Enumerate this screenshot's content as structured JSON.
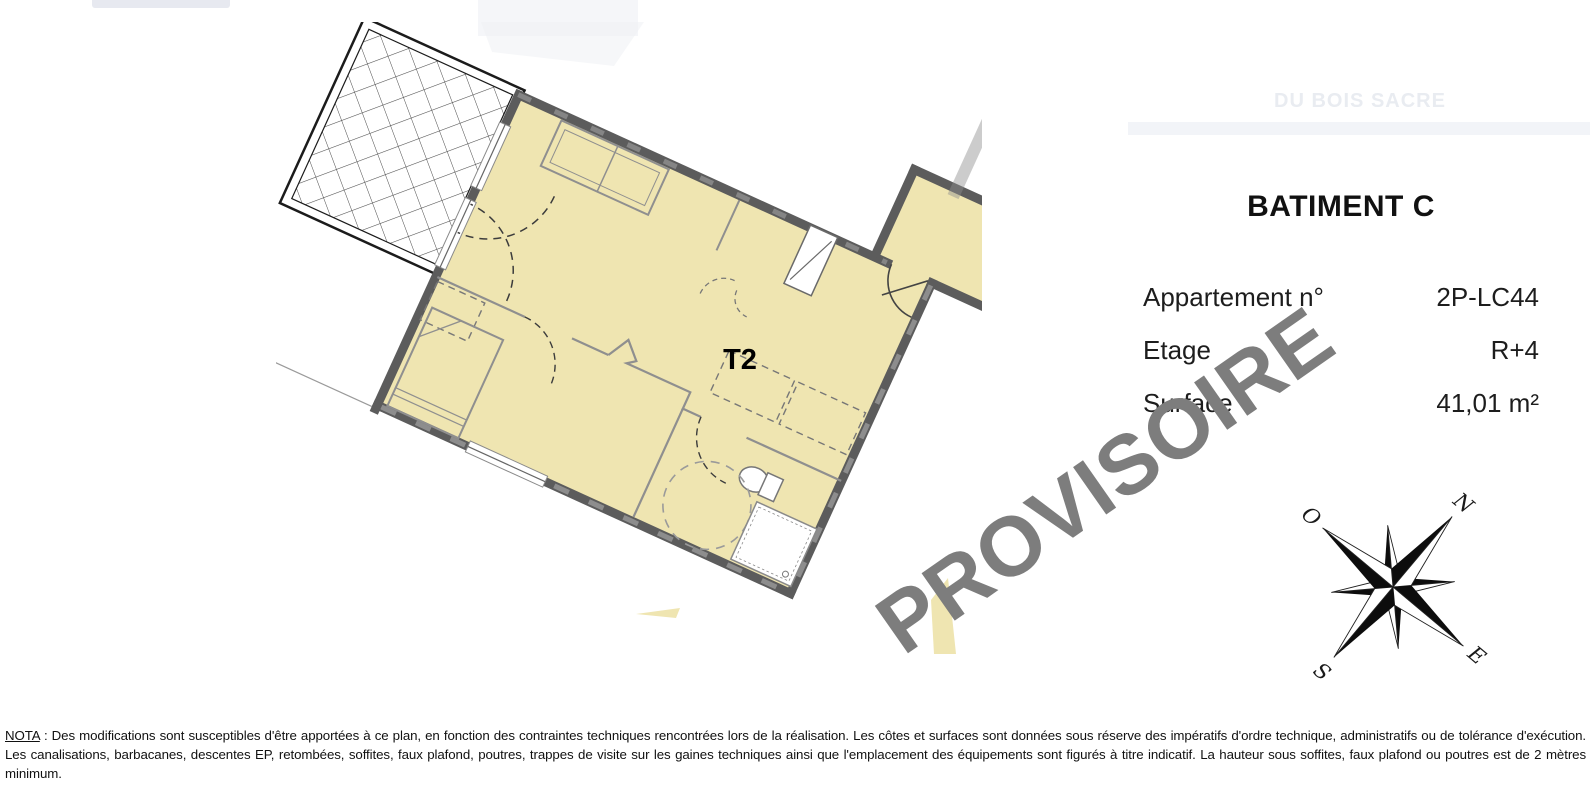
{
  "header": {
    "faint_project_line": "DU BOIS SACRE"
  },
  "plan": {
    "unit_label": "T2",
    "rotation_deg": 24.5,
    "colors": {
      "floor_fill": "#EFE5B1",
      "wall": "#5c5c5c",
      "thin_line": "#8f8f8f",
      "watermark": "#7d7d7d"
    },
    "features": [
      "hatched-balcony",
      "living-room",
      "kitchen-counter",
      "bedroom-with-bed",
      "bathroom-with-shower-toilet",
      "accessibility-turning-circle",
      "entry-door-swing",
      "balcony-door-swings",
      "windows",
      "duct-shaft"
    ]
  },
  "info_panel": {
    "title": "BATIMENT C",
    "rows": [
      {
        "label": "Appartement n°",
        "value": "2P-LC44"
      },
      {
        "label": "Etage",
        "value": "R+4"
      },
      {
        "label": "Surface",
        "value": "41,01 m²"
      }
    ]
  },
  "watermark": {
    "text": "PROVISOIRE",
    "rotation_deg": -35,
    "color": "#7d7d7d"
  },
  "compass": {
    "rotation_deg": 40,
    "labels": {
      "north": "N",
      "east": "E",
      "south": "S",
      "west": "O"
    }
  },
  "footer": {
    "nota_label": "NOTA",
    "nota_text": " : Des modifications sont susceptibles d'être apportées à ce plan, en fonction des contraintes techniques rencontrées lors de la réalisation. Les côtes et surfaces sont données sous réserve des impératifs d'ordre technique, administratifs ou de tolérance d'exécution. Les canalisations, barbacanes, descentes EP, retombées, soffites, faux plafond, poutres, trappes de visite sur les gaines techniques ainsi que l'emplacement des équipements sont figurés à titre indicatif. La hauteur sous soffites, faux plafond ou poutres est de 2 mètres minimum."
  }
}
